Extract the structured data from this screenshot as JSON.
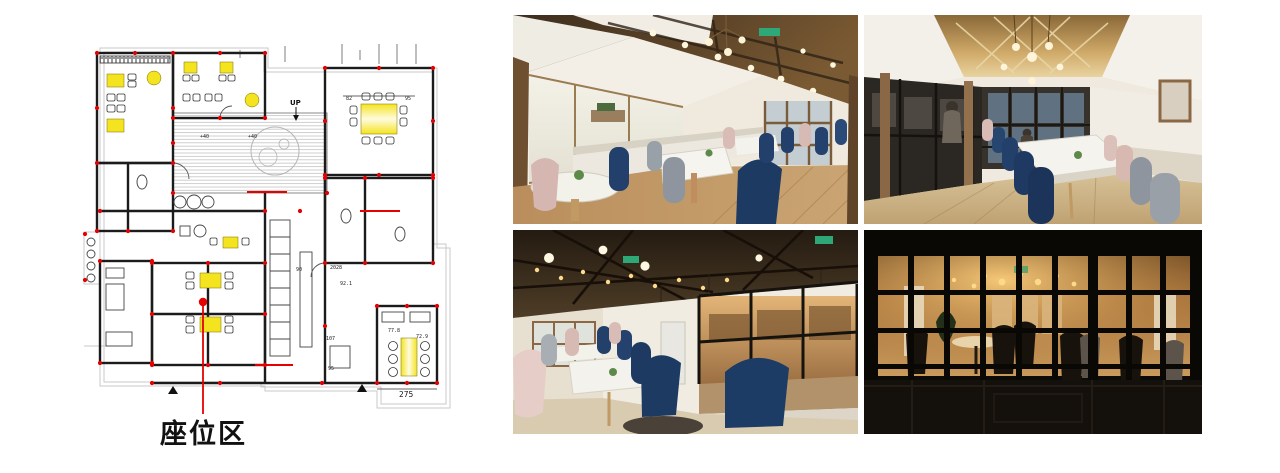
{
  "page": {
    "background": "#ffffff",
    "title": "restaurant-design-presentation"
  },
  "floorplan": {
    "label": "座位区",
    "annotations": {
      "up": "UP",
      "dim_82": "82",
      "dim_95_top": "95",
      "dim_90": "90",
      "dim_2028": "2028",
      "dim_92_1": "92.1",
      "dim_107": "107",
      "dim_95_bottom": "95",
      "dim_72_9": "72.9",
      "dim_77_8": "77.8",
      "dim_275": "275",
      "level_40a": "+40",
      "level_40b": "+40"
    },
    "colors": {
      "highlight_yellow": "#f4e41f",
      "marker_red": "#e60000",
      "wall_black": "#1b1b1b",
      "guide_gray": "#c9c9c9"
    }
  },
  "photos": [
    {
      "name": "photo-dining-window-side",
      "alt": "Dining room with frosted windows, marble tables, navy, grey and pink velvet chairs, wooden beam ceiling with exit sign"
    },
    {
      "name": "photo-dining-long-hall",
      "alt": "Long dining hall with mirrored gold ceiling, globe lights, black framed kitchen partition, long marble table with velvet chairs"
    },
    {
      "name": "photo-dining-truss-ceiling",
      "alt": "Seating area under dark timber truss ceiling with string lights, glass partition to kitchen, marble tables, navy and pink chairs"
    },
    {
      "name": "photo-night-facade",
      "alt": "Night view through black grid-paned facade windows into warm lit cafe interior"
    }
  ]
}
